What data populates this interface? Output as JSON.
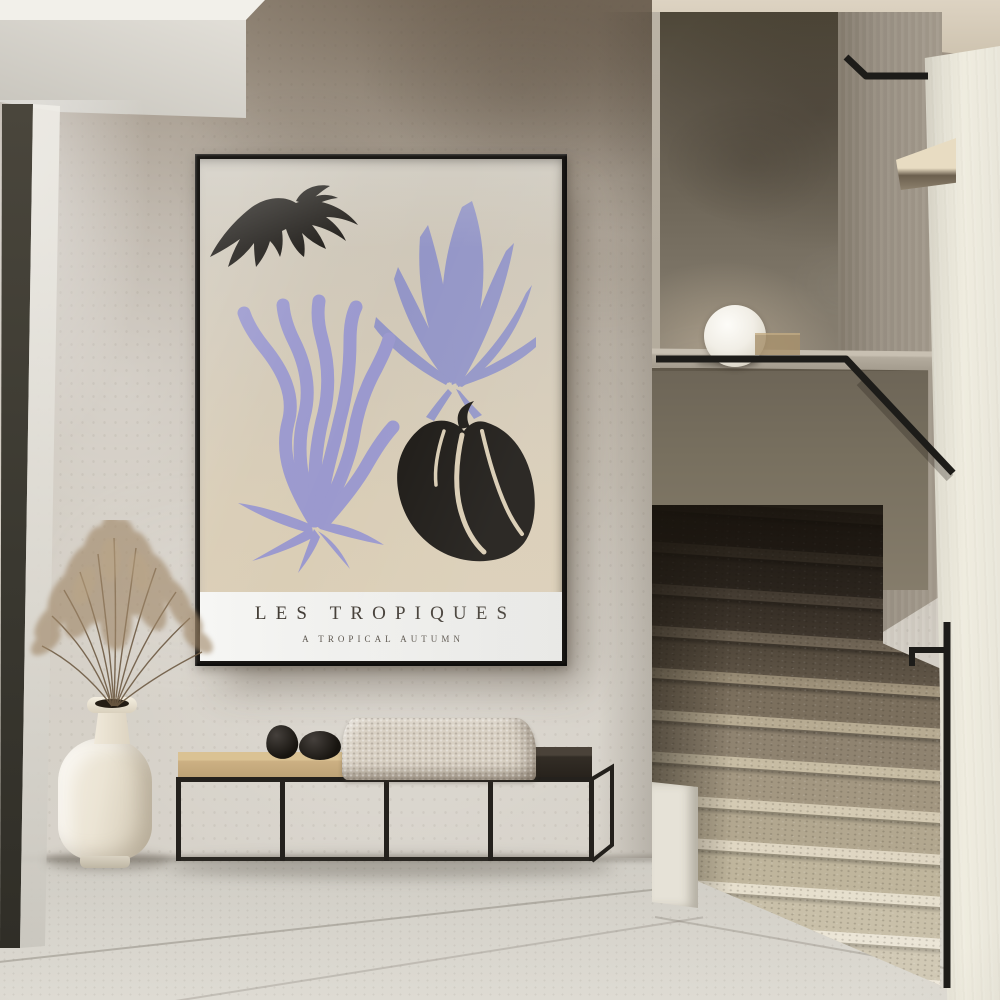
{
  "scene": {
    "setting": "minimalist hallway with framed art poster, bench, vase and terrazzo staircase",
    "poster": {
      "title": "LES TROPIQUES",
      "subtitle": "A TROPICAL AUTUMN",
      "style": "botanical cut-out print",
      "paper_color": "#d6cbb6",
      "band_color": "#f3f3f1",
      "frame_color": "#191715",
      "title_color": "#423c35",
      "leaves": [
        {
          "name": "fan-palm-leaf",
          "color": "#1d1a16"
        },
        {
          "name": "monstera-leaf",
          "color": "#9496c7"
        },
        {
          "name": "seaweed-leaf",
          "color": "#9b99ce"
        },
        {
          "name": "heart-leaf",
          "color": "#1d1a16"
        }
      ]
    },
    "furniture": {
      "bench": {
        "frame_color": "#24211d",
        "seat_left_color": "#cdb283",
        "seat_right_color": "#332d26",
        "blanket_color": "#d8d0c3",
        "decor": "two black stones"
      },
      "vase": {
        "color": "#ece5d6",
        "contents": "dried pampas grass",
        "grass_color": "#a08768"
      }
    },
    "stairwell": {
      "lamp": {
        "shape": "sphere",
        "color": "#f4f1ea"
      },
      "handrail_color": "#1d1c19",
      "steps_light_color": "#efe9dc",
      "steps_shadow_color": "#4a4238"
    },
    "surfaces": {
      "wall_plaster": "#cfc9bf",
      "wall_upper_taupe": "#9b8f80",
      "ceiling": "#f2f0ea",
      "floor_tile": "#d6d3cb",
      "door_frame_dark": "#3f3c33"
    }
  }
}
